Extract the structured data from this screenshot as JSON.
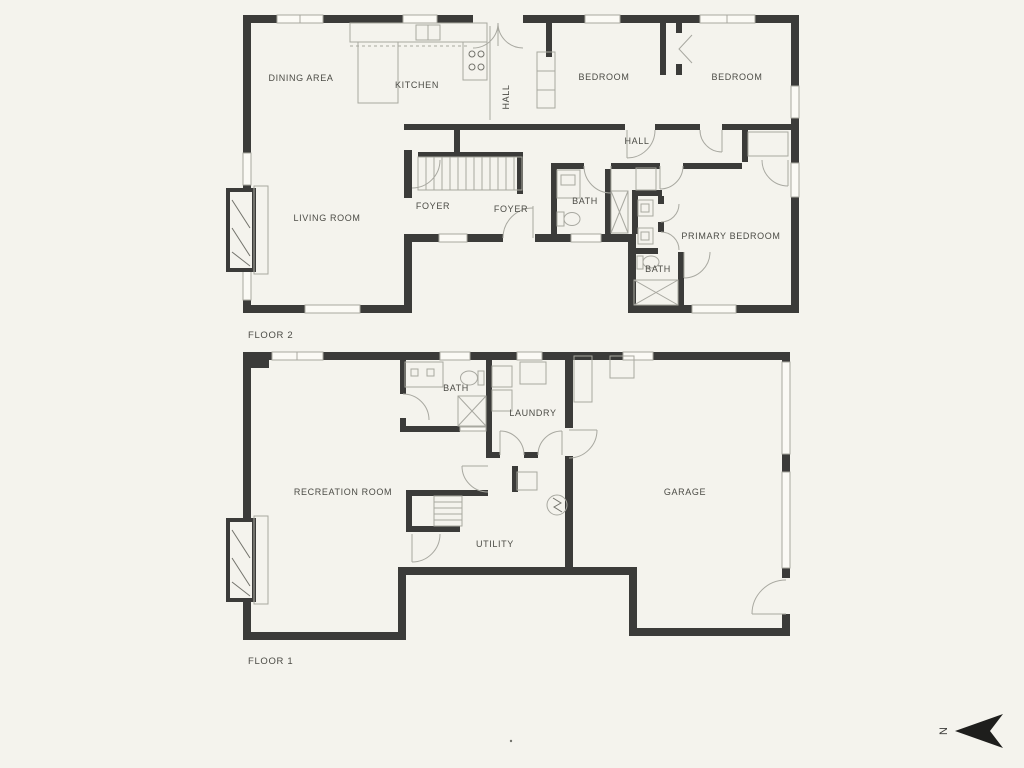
{
  "document": {
    "type": "two-story residential floor plan"
  },
  "colors": {
    "background": "#f4f3ed",
    "wall": "#3b3b39",
    "line": "#a8a8a0",
    "line_dark": "#73736c",
    "text": "#4b4b45",
    "compass": "#1e1e1c"
  },
  "floor2": {
    "title": "FLOOR 2",
    "dining": "DINING AREA",
    "kitchen": "KITCHEN",
    "hall_upper": "HALL",
    "bedroom_left": "BEDROOM",
    "bedroom_right": "BEDROOM",
    "hall": "HALL",
    "living": "LIVING ROOM",
    "foyer_left": "FOYER",
    "foyer_right": "FOYER",
    "bath_upper": "BATH",
    "primary": "PRIMARY BEDROOM",
    "bath_lower": "BATH"
  },
  "floor1": {
    "title": "FLOOR 1",
    "bath": "BATH",
    "laundry": "LAUNDRY",
    "recreation": "RECREATION ROOM",
    "garage": "GARAGE",
    "utility": "UTILITY"
  },
  "compass": {
    "north": "N"
  }
}
